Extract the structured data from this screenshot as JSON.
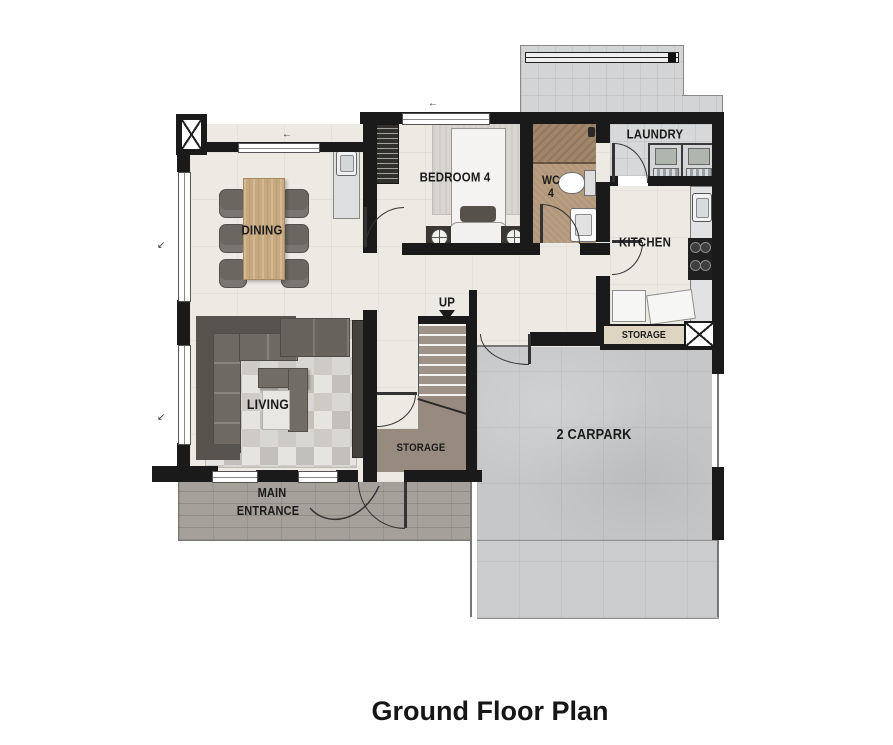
{
  "title": "Ground Floor Plan",
  "labels": {
    "dining": "DINING",
    "living": "LIVING",
    "bedroom4": "BEDROOM 4",
    "wc_line1": "WC",
    "wc_line2": "4",
    "laundry": "LAUNDRY",
    "kitchen": "KITCHEN",
    "up": "UP",
    "storage_stairs": "STORAGE",
    "storage_kitchen": "STORAGE",
    "carpark": "2 CARPARK",
    "entrance_line1": "MAIN",
    "entrance_line2": "ENTRANCE"
  },
  "colors": {
    "wall": "#1a1a1a",
    "floor_interior": "#edeae4",
    "floor_wc": "#b3977a",
    "floor_shower": "#a2866a",
    "floor_laundry": "#d7d8d9",
    "floor_service_yard": "#d3d4d5",
    "floor_carpark": "#c6c7c8",
    "floor_driveway": "#cbcccd",
    "floor_porch": "#a5a19a",
    "stairs": "#9d9389",
    "storage_floor": "#978b7f",
    "wood_table": "#c7a87f",
    "sofa": "#676159",
    "label_text": "#1b1b1b",
    "storage_tag_bg": "#ddd5c1"
  }
}
